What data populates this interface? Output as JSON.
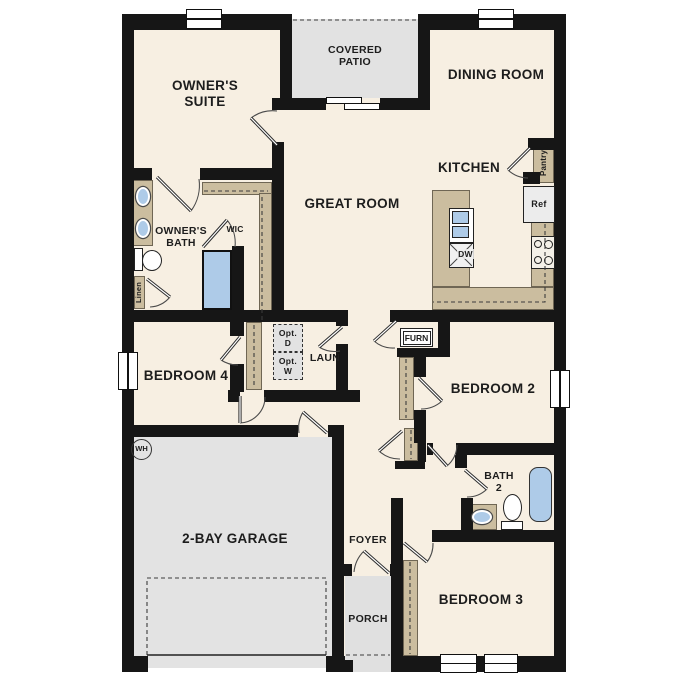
{
  "rooms": {
    "owners_suite": "OWNER'S SUITE",
    "covered_patio": "COVERED PATIO",
    "dining_room": "DINING ROOM",
    "kitchen": "KITCHEN",
    "great_room": "GREAT ROOM",
    "owners_bath": "OWNER'S BATH",
    "wic": "WIC",
    "bedroom_4": "BEDROOM 4",
    "laundry": "LAUN",
    "bedroom_2": "BEDROOM 2",
    "bath_2": "BATH 2",
    "bedroom_3": "BEDROOM 3",
    "garage": "2-BAY GARAGE",
    "foyer": "FOYER",
    "porch": "PORCH"
  },
  "fixtures": {
    "pantry": "Pantry",
    "refrigerator": "Ref",
    "dishwasher": "DW",
    "furnace": "FURN",
    "water_heater": "WH",
    "linen": "Linen",
    "opt_dryer": "Opt. D",
    "opt_washer": "Opt. W"
  },
  "colors": {
    "wall": "#161616",
    "floor": "#f7efe2",
    "hard_surface": "#e3e3e3",
    "casework_tan": "#cbbd9f",
    "plumbing_blue": "#aecbe8"
  }
}
